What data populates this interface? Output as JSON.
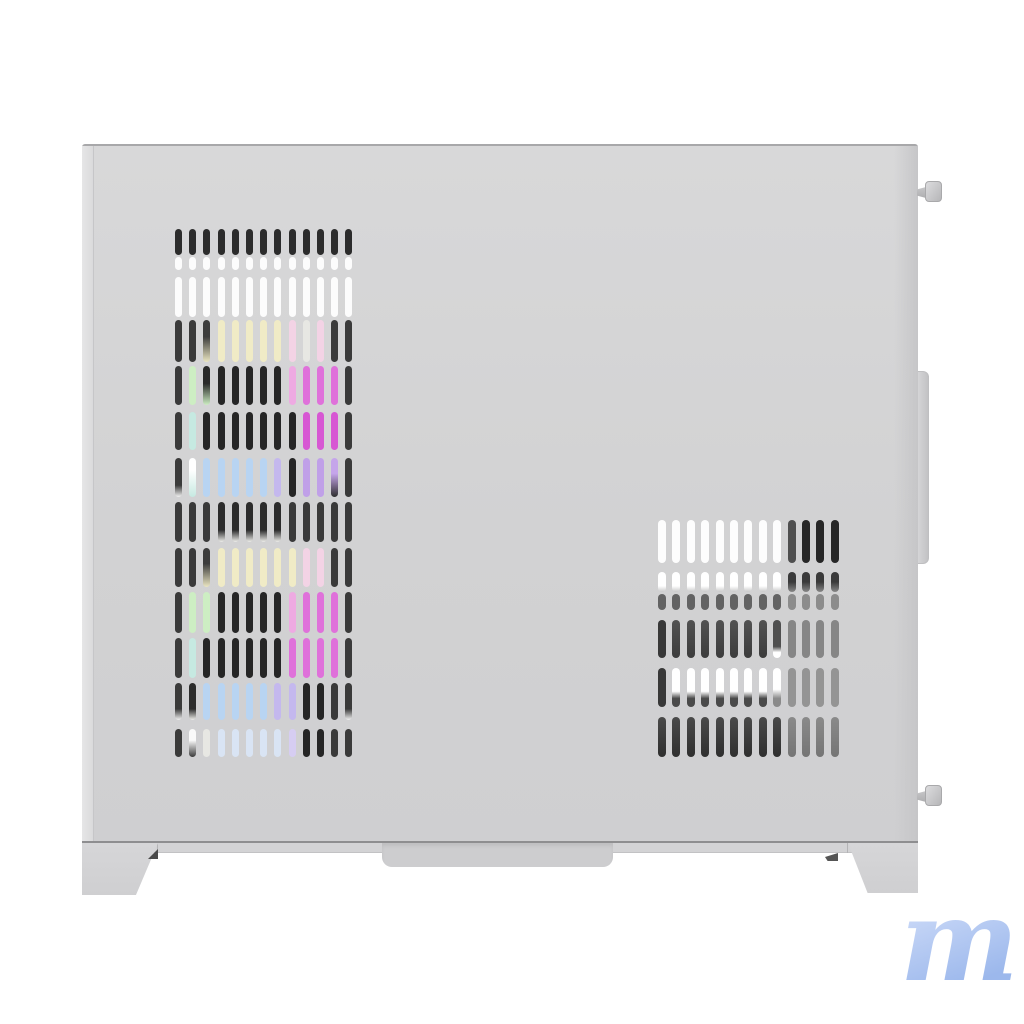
{
  "scene": {
    "type": "product-photo",
    "subject": "white mid-tower pc case side view with rgb fans behind left vent grille",
    "background_color": "#ffffff"
  },
  "watermark": {
    "text": "m",
    "gradient_from": "#c9d8f7",
    "gradient_to": "#9cb8ec"
  },
  "case": {
    "panel_color": "#d2d2d3",
    "panel_highlight": "#d8d8d9",
    "panel_shadow": "#cfcfd1",
    "top_edge_color": "#a8a8aa",
    "bottom_line_color": "#8e8e90",
    "skirt_color": "#d3d3d5",
    "center_tab_color": "#cdcdcf",
    "foot_color": "#d2d2d4",
    "trim_tab_color": "#cfcfd1",
    "screw_color": "#c9c9cb",
    "interior_color": "#3a3a3a"
  },
  "fans": {
    "count": 2,
    "ring_color": "#f0f0f0",
    "blade_color": "#262626",
    "glow_colors": [
      "#f0ebc6",
      "#cdeec3",
      "#c6e9e1",
      "#b8d4f2",
      "#c4b8ee",
      "#c0a0e8",
      "#df71da",
      "#f3d3e5"
    ]
  },
  "vent_palette": {
    "D0": "#2c2c2c",
    "D": "#3a3a3a",
    "K": "#262626",
    "W": "#fcfcfc",
    "Wd": "#e7e7e3",
    "CR": "#f0ebc6",
    "GN": "#cdeec3",
    "CY": "#c6e9e1",
    "BL": "#b8d4f2",
    "BLp": "#d9e4f4",
    "PU": "#c0a0e8",
    "LV": "#c4b8ee",
    "LVp": "#d6cdf2",
    "MG": "#df71da",
    "MG2": "#d757d3",
    "PK": "#f3d3e5",
    "PKm": "#eeaae2",
    "d-cr": "linear-gradient(180deg,#3c3c3c 40%,#ebe6c2)",
    "k-gn": "linear-gradient(180deg,#2a2a2a 45%,#cdeec3)",
    "d-w": "linear-gradient(180deg,#3a3a3a 70%,#f2f2f2)",
    "w-d": "linear-gradient(180deg,#fafafa 40%,#3a3a3a)",
    "w-cy": "linear-gradient(180deg,#ffffff 30%,#c6e9e1)",
    "k-w": "linear-gradient(180deg,#2c2c2c 70%,#ededea)",
    "pu-k": "linear-gradient(180deg,#c5a5ea 40%,#2e2e2e)",
    "RW": "#fdfdfd",
    "RWt": "linear-gradient(180deg,#ffffff 70%,#c9c9c9)",
    "RD1": "#262626",
    "RD2": "#4f4f4f",
    "RDm": "linear-gradient(180deg,#3a3a3a 50%,#888888)",
    "RG1": "#636363",
    "RG2": "#8c8c8c",
    "RB1": "linear-gradient(180deg,#525252,#3c3c3c)",
    "RB1w": "linear-gradient(180deg,#4f4f4f 70%,#ffffff 85%)",
    "RB2": "#383838",
    "RWb": "linear-gradient(180deg,#ffffff 60%,#4a4a4a 78%)",
    "RWb2": "linear-gradient(180deg,#ffffff 55%,#8a8a8a 78%)",
    "RB3": "linear-gradient(180deg,#4a4a4a,#2f2f2f)",
    "RM1": "#868686",
    "RM2": "#949494",
    "RM3": "linear-gradient(180deg,#8a8a8a,#757575)"
  },
  "vents": {
    "left": {
      "cols": 13,
      "col_start": 175,
      "col_pitch": 14.2,
      "slot_width": 7,
      "rows": [
        [
          229,
          26,
          [
            "D0",
            "D0",
            "D0",
            "D0",
            "D0",
            "D0",
            "D0",
            "D0",
            "D0",
            "D0",
            "D0",
            "D0",
            "D0"
          ]
        ],
        [
          257,
          13,
          [
            "W",
            "W",
            "W",
            "W",
            "W",
            "W",
            "W",
            "W",
            "W",
            "W",
            "W",
            "W",
            "W"
          ]
        ],
        [
          277,
          40,
          [
            "W",
            "W",
            "W",
            "W",
            "W",
            "W",
            "W",
            "W",
            "W",
            "W",
            "W",
            "W",
            "W"
          ]
        ],
        [
          320,
          42,
          [
            "D",
            "D",
            "d-cr",
            "CR",
            "CR",
            "CR",
            "CR",
            "CR",
            "PK",
            "Wd",
            "PK",
            "D",
            "D"
          ]
        ],
        [
          366,
          39,
          [
            "D",
            "GN",
            "k-gn",
            "K",
            "K",
            "K",
            "K",
            "K",
            "PKm",
            "MG",
            "MG",
            "MG",
            "D"
          ]
        ],
        [
          412,
          38,
          [
            "D",
            "CY",
            "K",
            "K",
            "K",
            "K",
            "K",
            "K",
            "K",
            "MG2",
            "MG2",
            "MG2",
            "D"
          ]
        ],
        [
          458,
          39,
          [
            "d-w",
            "w-cy",
            "BL",
            "BL",
            "BL",
            "BL",
            "BL",
            "LV",
            "K",
            "PU",
            "PU",
            "pu-k",
            "D"
          ]
        ],
        [
          502,
          40,
          [
            "D",
            "D",
            "D",
            "k-w",
            "k-w",
            "k-w",
            "k-w",
            "k-w",
            "D",
            "D",
            "D",
            "D",
            "D"
          ]
        ],
        [
          548,
          39,
          [
            "D",
            "D",
            "d-cr",
            "CR",
            "CR",
            "CR",
            "CR",
            "CR",
            "CR",
            "PK",
            "PK",
            "D",
            "D"
          ]
        ],
        [
          592,
          41,
          [
            "D",
            "GN",
            "GN",
            "K",
            "K",
            "K",
            "K",
            "K",
            "PKm",
            "MG",
            "MG",
            "MG",
            "D"
          ]
        ],
        [
          638,
          40,
          [
            "D",
            "CY",
            "K",
            "K",
            "K",
            "K",
            "K",
            "K",
            "MG",
            "MG",
            "MG",
            "MG",
            "D"
          ]
        ],
        [
          683,
          37,
          [
            "d-w",
            "k-w",
            "BL",
            "BL",
            "BL",
            "BL",
            "BL",
            "LV",
            "LV",
            "K",
            "K",
            "D",
            "d-w"
          ]
        ],
        [
          729,
          28,
          [
            "D",
            "w-d",
            "Wd",
            "BLp",
            "BLp",
            "BLp",
            "BLp",
            "BLp",
            "LVp",
            "K",
            "K",
            "D",
            "D"
          ]
        ]
      ]
    },
    "right": {
      "cols": 13,
      "col_start": 658,
      "col_pitch": 14.4,
      "slot_width": 8,
      "rows": [
        [
          520,
          43,
          [
            "RW",
            "RW",
            "RW",
            "RW",
            "RW",
            "RW",
            "RW",
            "RW",
            "RW",
            "RD2",
            "RD1",
            "RD1",
            "RD1"
          ]
        ],
        [
          572,
          20,
          [
            "RWt",
            "RWt",
            "RWt",
            "RWt",
            "RWt",
            "RWt",
            "RWt",
            "RWt",
            "RWt",
            "RDm",
            "RDm",
            "RDm",
            "RDm"
          ]
        ],
        [
          594,
          16,
          [
            "RG1",
            "RG1",
            "RG1",
            "RG1",
            "RG1",
            "RG1",
            "RG1",
            "RG1",
            "RG1",
            "RG2",
            "RG2",
            "RG2",
            "RG2"
          ]
        ],
        [
          620,
          38,
          [
            "RB2",
            "RB1",
            "RB1",
            "RB1",
            "RB1",
            "RB1",
            "RB1",
            "RB1",
            "RB1w",
            "RM1",
            "RM1",
            "RM1",
            "RM1"
          ]
        ],
        [
          668,
          39,
          [
            "RB2",
            "RWb",
            "RWb",
            "RWb",
            "RWb",
            "RWb",
            "RWb",
            "RWb",
            "RWb2",
            "RM2",
            "RM2",
            "RM2",
            "RM2"
          ]
        ],
        [
          717,
          40,
          [
            "RB3",
            "RB3",
            "RB3",
            "RB3",
            "RB3",
            "RB3",
            "RB3",
            "RB3",
            "RB3",
            "RM3",
            "RM3",
            "RM3",
            "RM3"
          ]
        ]
      ]
    }
  }
}
